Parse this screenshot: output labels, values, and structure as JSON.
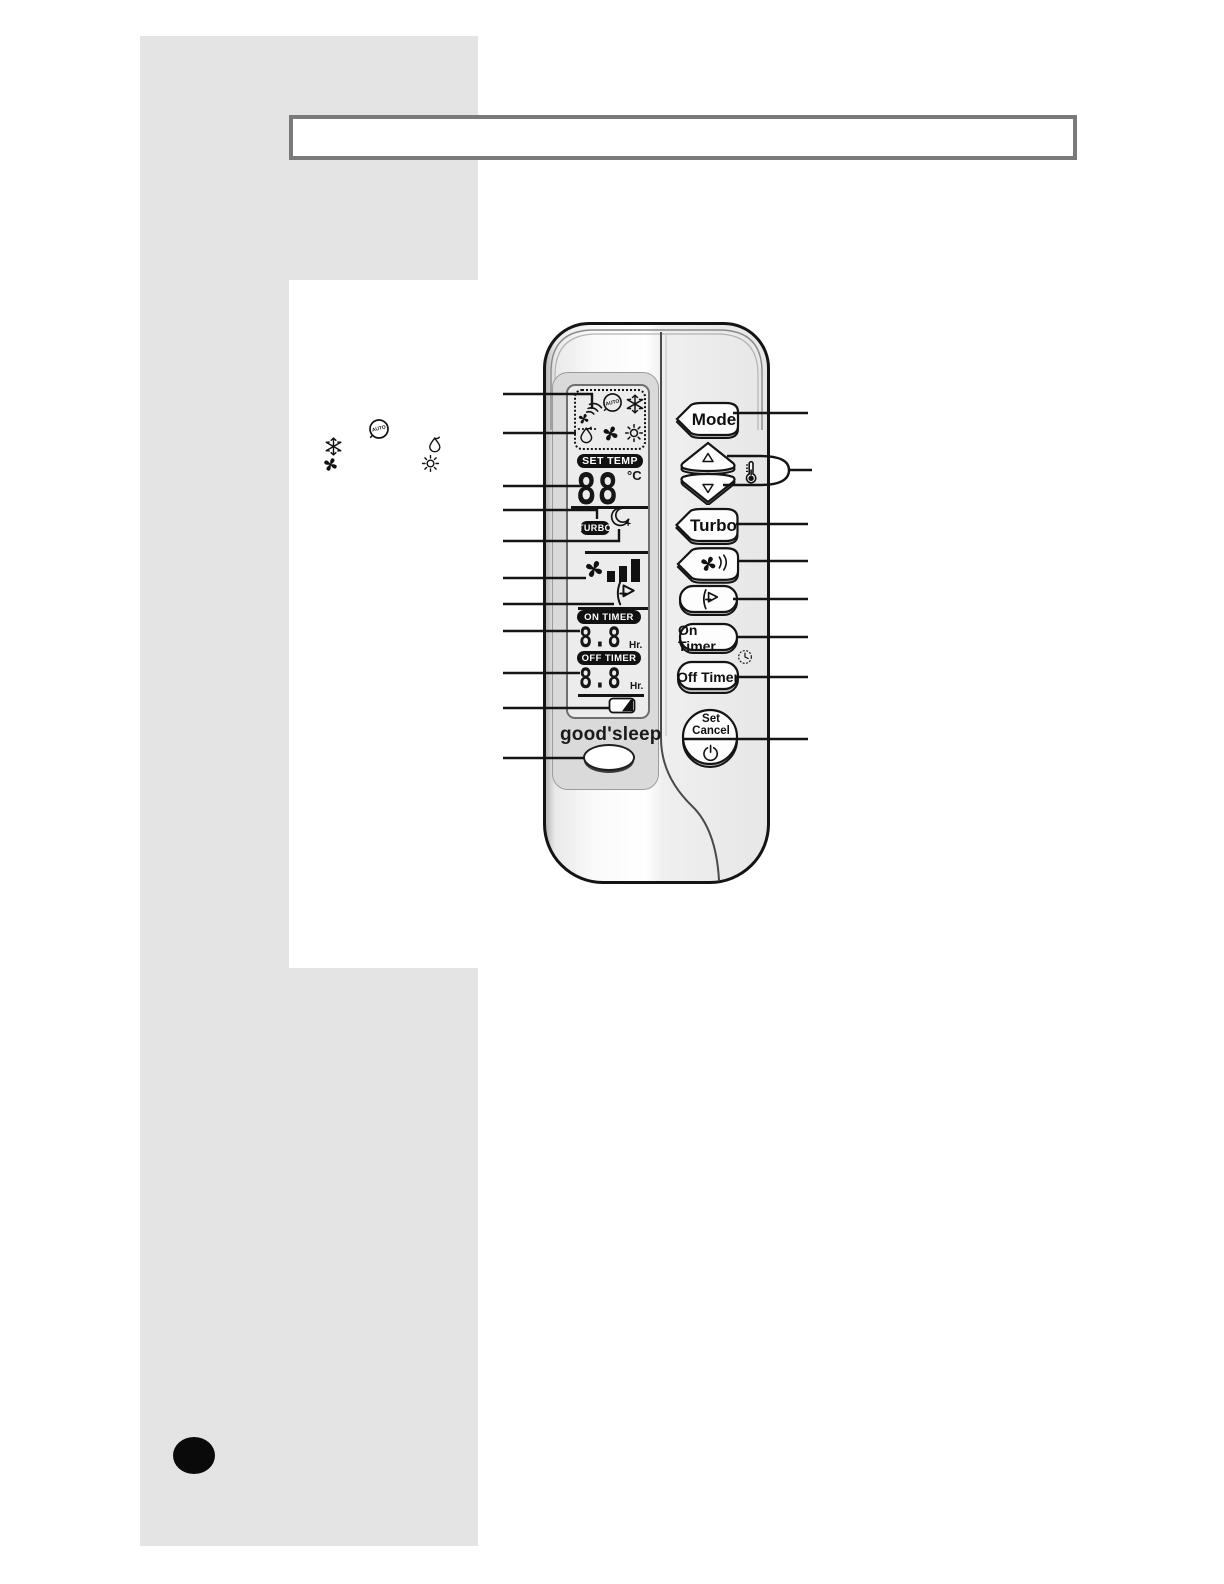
{
  "title_bar": {
    "text": ""
  },
  "legend": {
    "auto_label": "AUTO"
  },
  "display": {
    "auto_label": "AUTO",
    "set_temp_label": "SET TEMP",
    "temperature": "88",
    "temp_unit": "°C",
    "turbo_label": "TURBO",
    "on_timer_label": "ON TIMER",
    "on_timer_value": "8.8",
    "on_timer_unit": "Hr.",
    "off_timer_label": "OFF TIMER",
    "off_timer_value": "8.8",
    "off_timer_unit": "Hr.",
    "goodsleep_label": "good'sleep"
  },
  "buttons": {
    "mode": "Mode",
    "turbo": "Turbo",
    "on_timer": "On Timer",
    "off_timer": "Off Timer",
    "set": "Set",
    "cancel": "Cancel"
  },
  "icons": {
    "transmission": "signal-arcs-over-fan",
    "auto_mode": "circled-auto",
    "cool_mode": "snowflake",
    "dry_mode": "water-drop",
    "fan_mode": "fan",
    "heat_mode": "sun",
    "goodsleep": "crescent-moon",
    "fan_speed": "fan-with-bars",
    "air_swing": "louver-arrow",
    "temperature_adjust": "thermometer",
    "timer": "clock",
    "battery": "battery",
    "power": "power-symbol"
  },
  "colors": {
    "sidebar": "#e4e4e4",
    "line_black": "#141414",
    "badge_bg": "#111111",
    "badge_text": "#ffffff",
    "remote_body": "#f5f5f5"
  }
}
